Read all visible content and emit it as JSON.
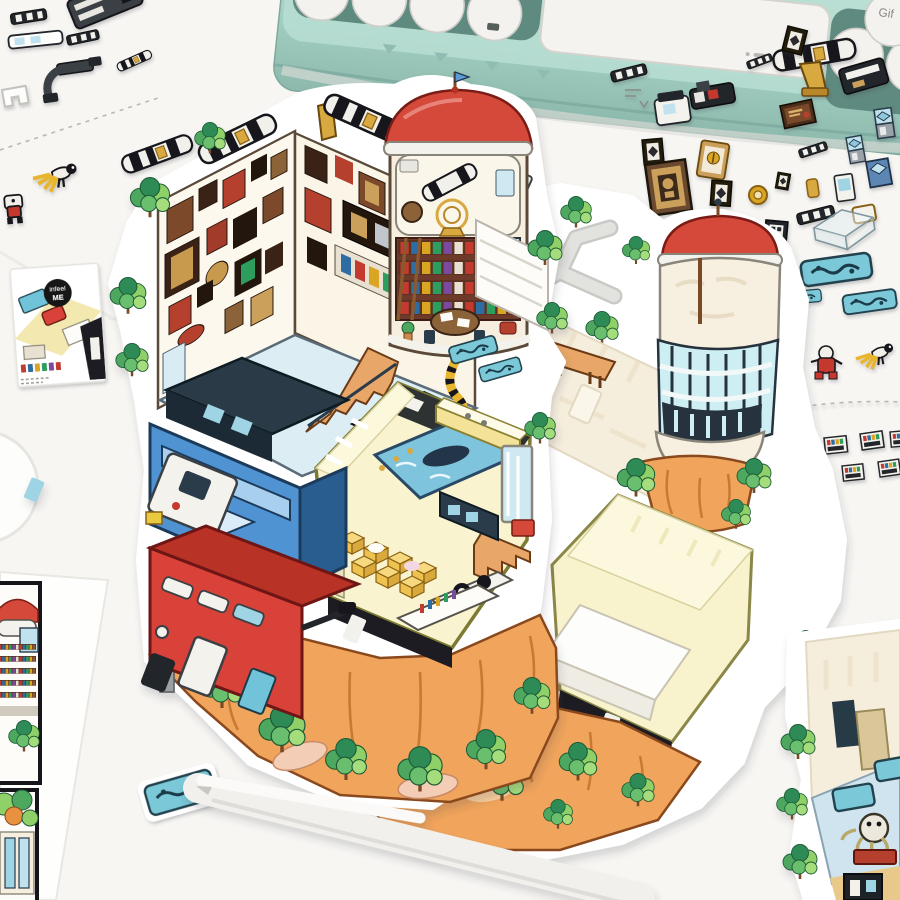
{
  "image_type": "product-photo",
  "scene_summary": "Die-cut isometric building sticker set spread on a white desk below a mint typewriter-style keyboard; tweezers hold a small aquarium sticker",
  "background": {
    "desk_color": "#f7f6f3"
  },
  "keyboard": {
    "name": "mint mechanical keyboard",
    "body_color": "#a9d2c6",
    "keycap_color": "#f3f2ef",
    "spacebar": true,
    "visible_key_label": "Gif"
  },
  "badge": {
    "line1": "infeel",
    "line2": "ME",
    "bg_color": "#141414",
    "text_color": "#ffffff"
  },
  "stickers": {
    "main_sticker": {
      "description": "fully illustrated isometric diorama",
      "elements": [
        "picture-frame museum room",
        "red-dome library tower with telescope observatory",
        "hexagon living room with yellow sofa and pool",
        "blue container block",
        "red double-deck bus block",
        "orange cliff with trees"
      ],
      "colors": {
        "cliff": "#f0a45b",
        "dome": "#d5493a",
        "hex_wall": "#f9f4cf",
        "pool": "#7fc4dd",
        "bus": "#d84238",
        "container": "#4f93d2"
      }
    },
    "blank_sticker": {
      "description": "blank cream template version of the diorama",
      "elements": [
        "gray paths",
        "glass cylinder tower with red dome",
        "empty pale-yellow hexagon room",
        "orange cliff with trees",
        "wood bench",
        "gray pole"
      ],
      "colors": {
        "cream": "#f6eedd",
        "glass": "#cdeef2",
        "hex": "#f8f3cc"
      }
    },
    "corner_sticker": {
      "description": "partially decorated room fragment in lower-right corner",
      "elements": [
        "cream wall",
        "blue aquarium floor",
        "octopus robot",
        "edge trees"
      ]
    },
    "small_stickers": [
      "striped telescope tube",
      "picture frames",
      "certificate frame",
      "tribal-mask frame",
      "QR frame",
      "gold medal",
      "display cases",
      "vending machines",
      "glass box",
      "teal aquarium trays",
      "waiter robot",
      "red robot",
      "secretary bird",
      "wood ladder",
      "mini bookshelves",
      "component slats",
      "pipe bracket"
    ],
    "printed_card": {
      "description": "small preview card with infeel ME badge"
    },
    "printed_sheet": {
      "description": "partial instruction sheet with two framed panels at lower left"
    }
  },
  "tools": {
    "tweezers_color": "#f2f0ec",
    "held_sticker": "teal aquarium tray"
  }
}
